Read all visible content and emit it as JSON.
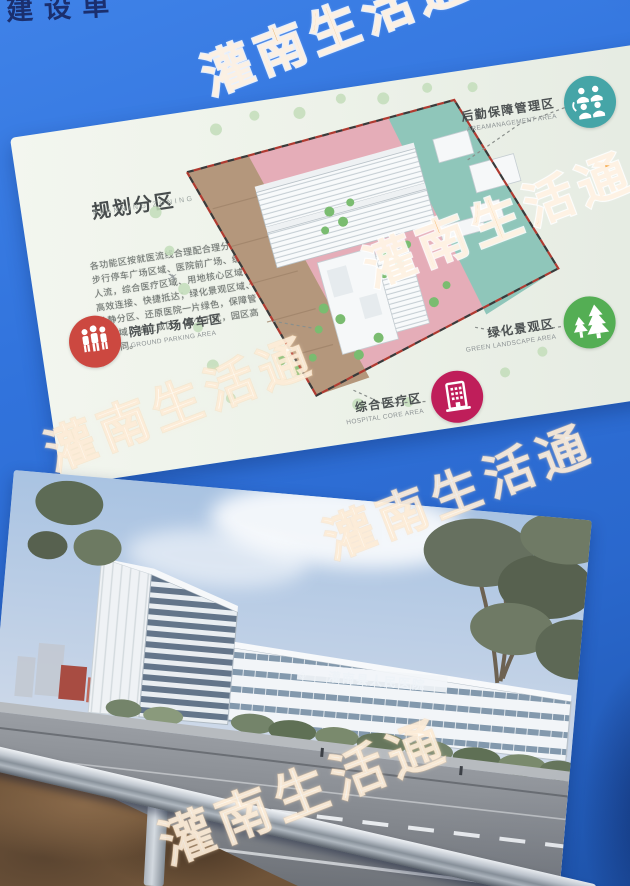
{
  "billboard": {
    "top_partial_text": "建设单",
    "blue": "#2f72da"
  },
  "watermark": {
    "text": "灌南生活通",
    "orange": "#f69826"
  },
  "planning_poster": {
    "title": "规划分区",
    "subtitle": "PLANNING ZONING",
    "description": "各功能区按就医流线合理配合理分区，步行停车广场区域、医院前广场、缓冲人流，综合医疗区域、用地核心区域、高效连接、快捷抵达；绿化景观区域、动静分区、还原医院一片绿色，保障管理区域、独立成区、减少干扰，园区高效协同。",
    "north_plane_icon": "✈",
    "labels": [
      {
        "zh": "后勤保障管理区",
        "en": "AREAMANAGEMENT AREA",
        "color": "#45a5a7",
        "icon": "people-group-icon"
      },
      {
        "zh": "绿化景观区",
        "en": "GREEN LANDSCAPE AREA",
        "color": "#54ae54",
        "icon": "pine-trees-icon"
      },
      {
        "zh": "综合医疗区",
        "en": "HOSPITAL CORE AREA",
        "color": "#bf1e5a",
        "icon": "hospital-building-icon"
      },
      {
        "zh": "院前广场停车区",
        "en": "GROUND PARKING AREA",
        "color": "#cc4840",
        "icon": "people-icon"
      }
    ],
    "zone_colors": {
      "medical_pink": "#e5adb8",
      "parking_tan": "#b4977c",
      "logistics_teal": "#8fc6ba",
      "landscape_green": "#7abc70"
    }
  },
  "rendering_poster": {
    "sign_logo": "◇",
    "building_sign": "灌南县人民医院"
  }
}
